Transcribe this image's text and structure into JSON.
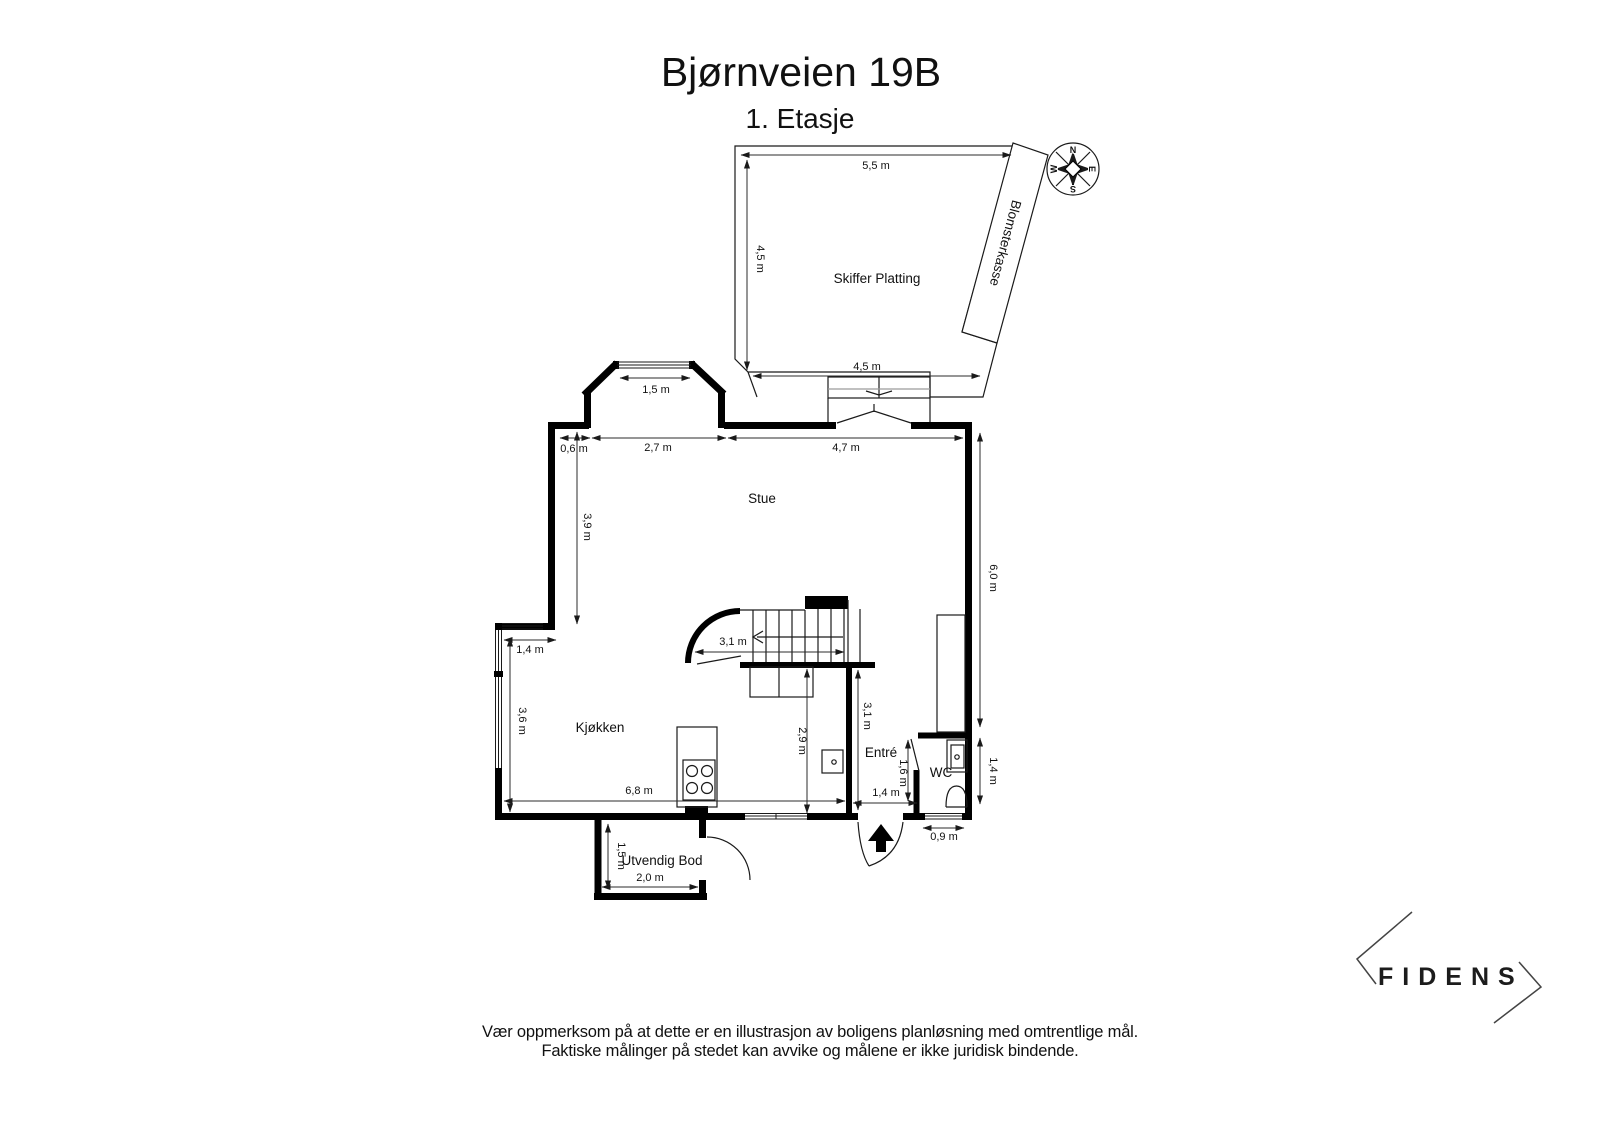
{
  "header": {
    "title": "Bjørnveien 19B",
    "subtitle": "1. Etasje"
  },
  "rooms": {
    "platting": "Skiffer Platting",
    "blomsterkasse": "Blomsterkasse",
    "stue": "Stue",
    "kjokken": "Kjøkken",
    "entre": "Entré",
    "wc": "WC",
    "bod": "Utvendig Bod"
  },
  "dimensions": {
    "platting_top": "5,5 m",
    "platting_left": "4,5 m",
    "platting_bottom": "4,5 m",
    "bay_window": "1,5 m",
    "stue_offset": "0,6 m",
    "stue_top_left": "2,7 m",
    "stue_top_right": "4,7 m",
    "stue_left_height": "3,9 m",
    "kitchen_window": "1,4 m",
    "kitchen_left_height": "3,6 m",
    "kitchen_width": "6,8 m",
    "stair_width": "3,1 m",
    "entre_height": "3,1 m",
    "entre_inner_height": "2,9 m",
    "entre_wc_gap": "1,6 m",
    "entre_door_width": "1,4 m",
    "wc_window": "0,9 m",
    "right_height": "6,0 m",
    "wc_height": "1,4 m",
    "bod_height": "1,5 m",
    "bod_width": "2,0 m"
  },
  "compass": {
    "n": "N",
    "e": "E",
    "s": "S",
    "w": "W"
  },
  "logo": {
    "name": "FIDENS"
  },
  "disclaimer": {
    "line1": "Vær oppmerksom på at dette er en illustrasjon av boligens planløsning med omtrentlige mål.",
    "line2": "Faktiske målinger på stedet kan avvike og målene er ikke juridisk bindende."
  }
}
